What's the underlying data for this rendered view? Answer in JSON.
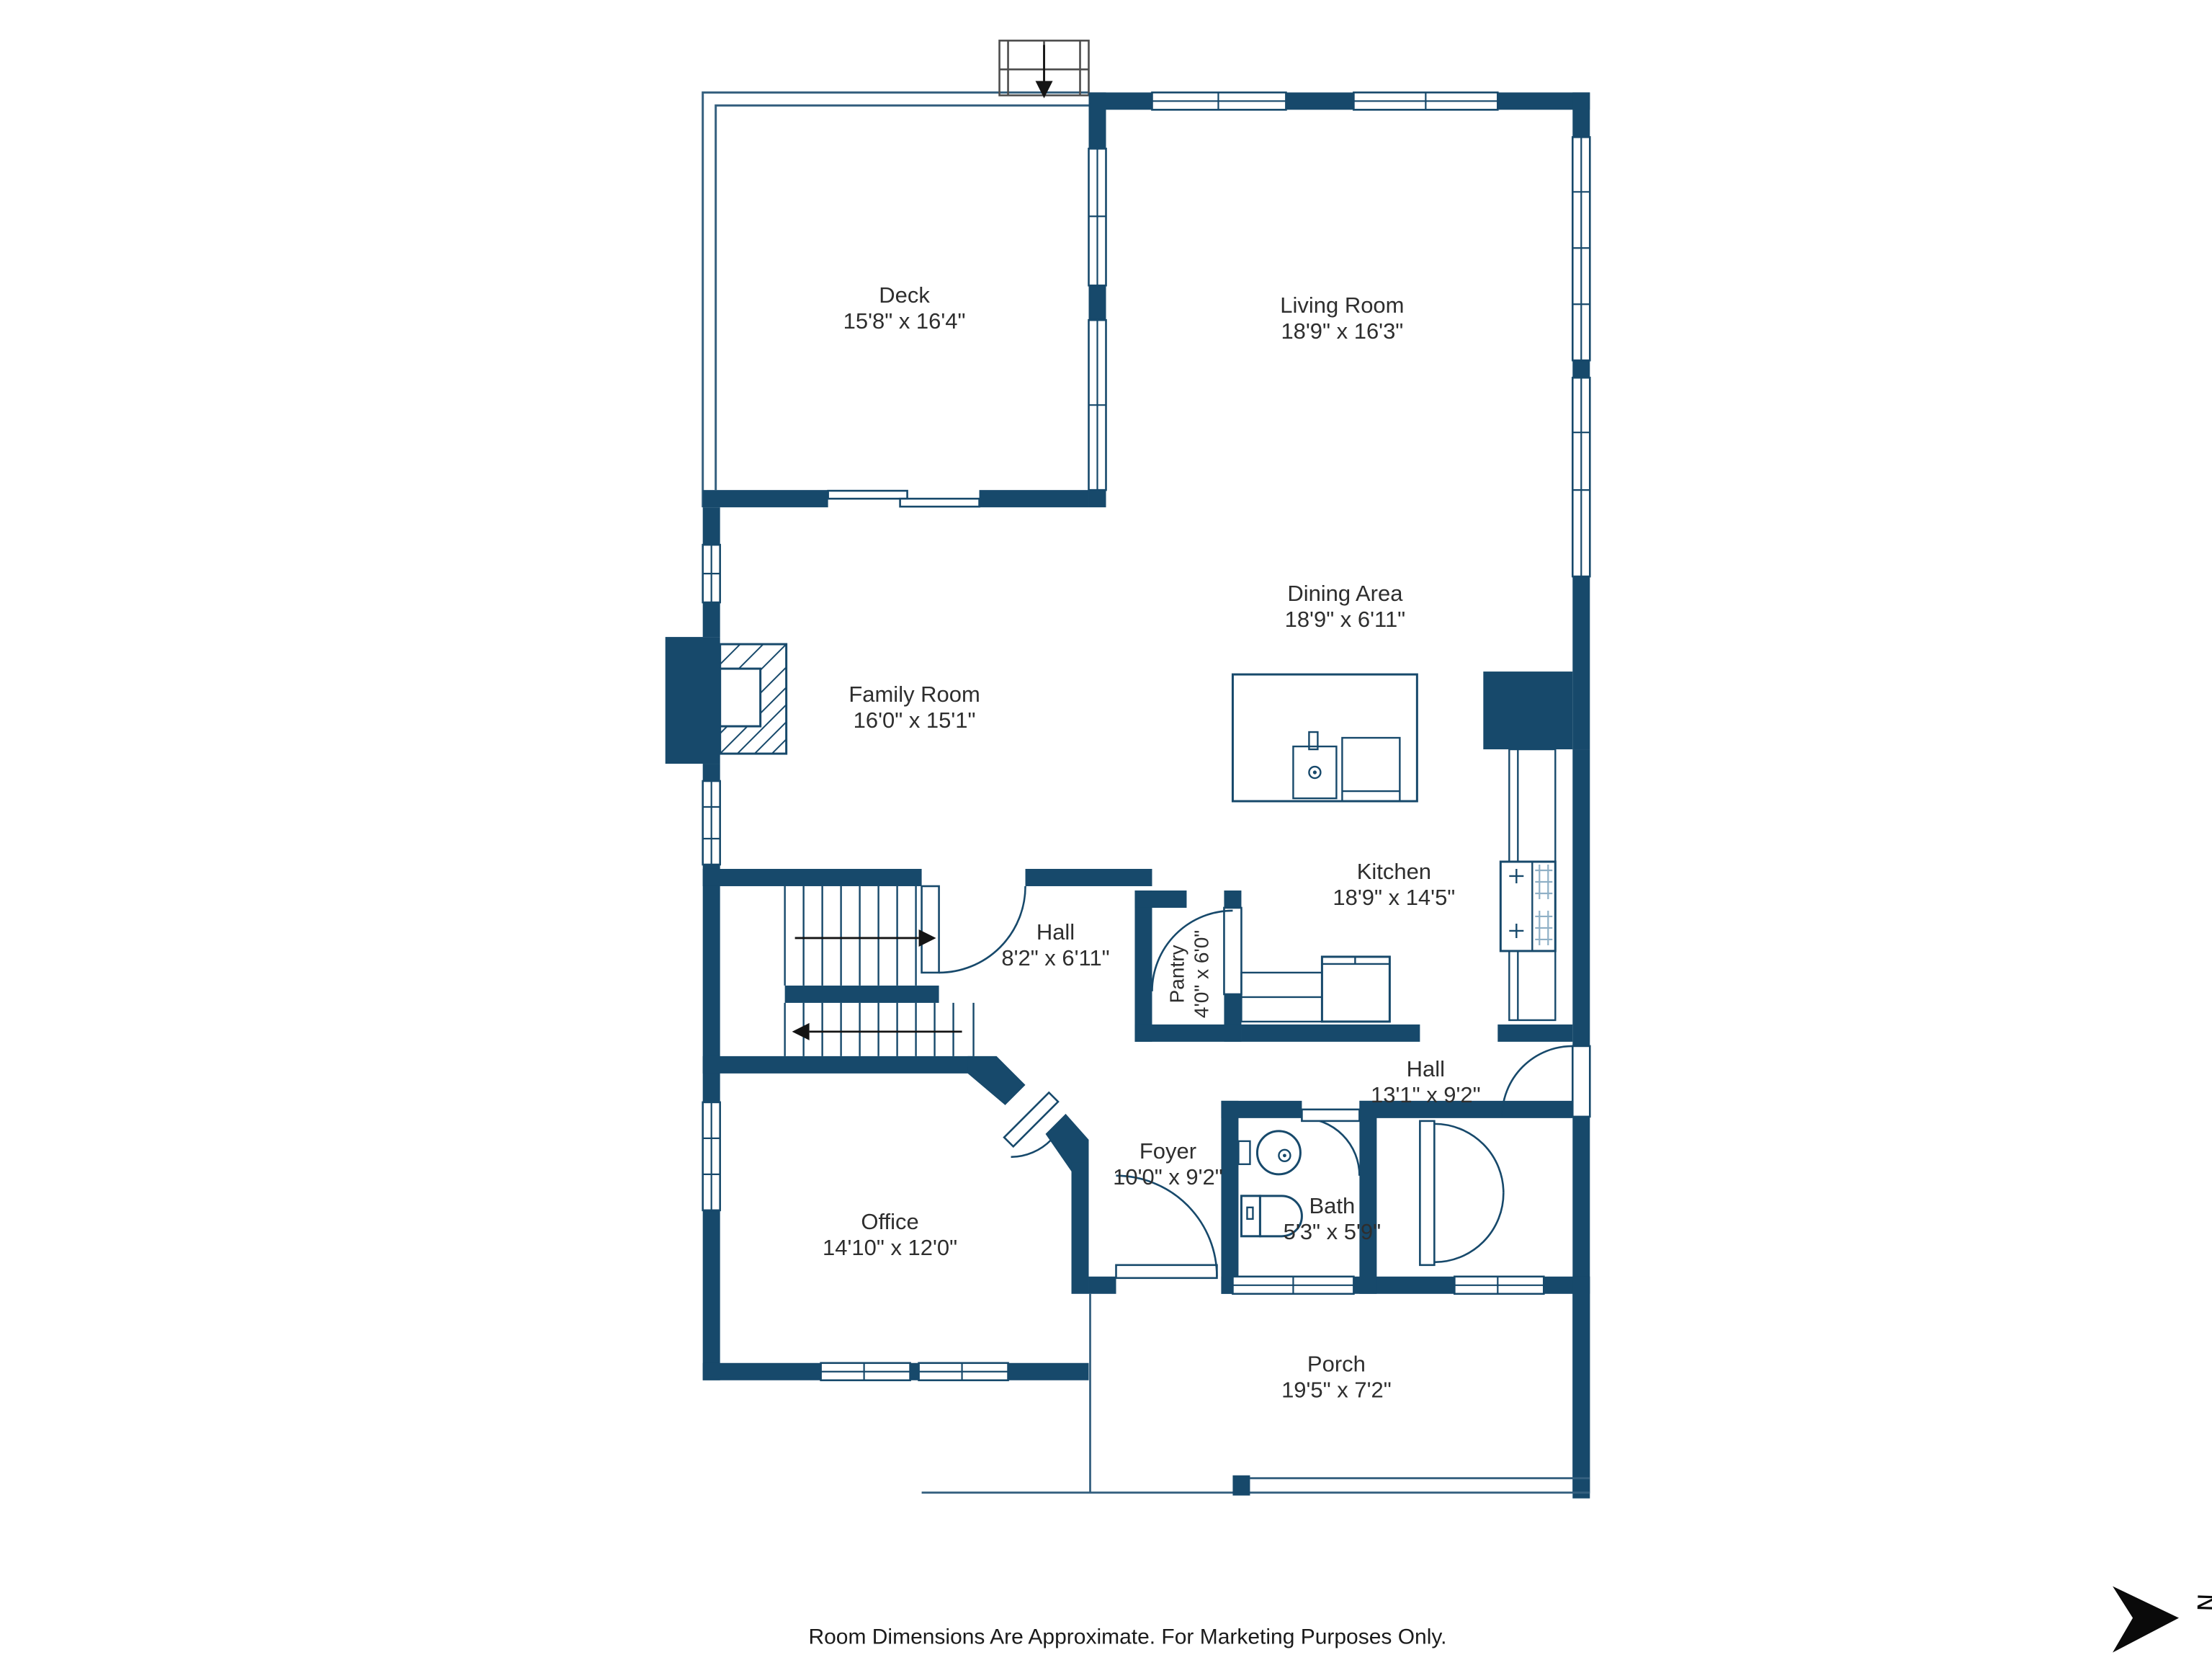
{
  "plan": {
    "rooms": {
      "deck": {
        "name": "Deck",
        "dims": "15'8\" x 16'4\""
      },
      "living_room": {
        "name": "Living Room",
        "dims": "18'9\" x 16'3\""
      },
      "dining_area": {
        "name": "Dining Area",
        "dims": "18'9\" x 6'11\""
      },
      "family_room": {
        "name": "Family Room",
        "dims": "16'0\" x 15'1\""
      },
      "kitchen": {
        "name": "Kitchen",
        "dims": "18'9\" x 14'5\""
      },
      "hall_upper": {
        "name": "Hall",
        "dims": "8'2\" x 6'11\""
      },
      "pantry": {
        "name": "Pantry",
        "dims": "4'0\" x 6'0\""
      },
      "hall_lower": {
        "name": "Hall",
        "dims": "13'1\" x 9'2\""
      },
      "foyer": {
        "name": "Foyer",
        "dims": "10'0\" x 9'2\""
      },
      "bath": {
        "name": "Bath",
        "dims": "5'3\" x 5'9\""
      },
      "office": {
        "name": "Office",
        "dims": "14'10\" x 12'0\""
      },
      "porch": {
        "name": "Porch",
        "dims": "19'5\" x 7'2\""
      }
    },
    "footer": "Room Dimensions Are Approximate. For Marketing Purposes Only.",
    "compass": {
      "label": "N"
    },
    "colors": {
      "wall": "#17496b",
      "text": "#2e2e2e",
      "stair_outline": "#4d4d4d"
    }
  }
}
